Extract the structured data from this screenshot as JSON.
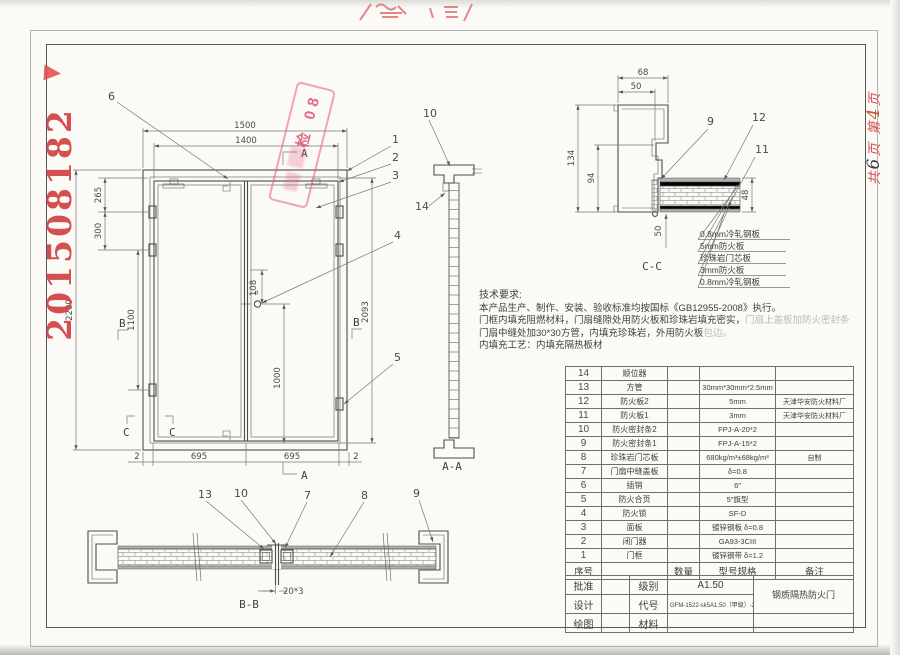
{
  "stamps": {
    "serial": "201508182",
    "inspection": "检 08",
    "page_note": {
      "p1": "共",
      "n1": "6",
      "p2": "页",
      "p3": "第",
      "n2": "4",
      "p4": "页"
    }
  },
  "elevation": {
    "dims": {
      "w_frame": "1500",
      "w_leaf": "1400",
      "h_frame": "2200",
      "h_leaf": "2093",
      "hinge1": "265",
      "hinge2": "300",
      "hinge3": "1100",
      "lock_off": "108",
      "lock_h": "1000",
      "gap_l": "2",
      "leaf_l": "695",
      "leaf_r": "695",
      "gap_r": "2"
    },
    "leaders": {
      "n1": "1",
      "n2": "2",
      "n3": "3",
      "n4": "4",
      "n5": "5",
      "n6": "6",
      "n10": "10",
      "n14": "14"
    },
    "marks": {
      "a": "A",
      "b": "B",
      "c": "C"
    }
  },
  "section_aa": {
    "label": "A-A"
  },
  "section_bb": {
    "label": "B-B",
    "dim": "20*3",
    "leaders": {
      "n13": "13",
      "n10": "10",
      "n7": "7",
      "n8": "8",
      "n9": "9"
    }
  },
  "detail_cc": {
    "label": "C-C",
    "dims": {
      "d68": "68",
      "d50": "50",
      "d134": "134",
      "d94": "94",
      "d48": "48",
      "d50b": "50"
    },
    "leaders": {
      "n9": "9",
      "n12": "12",
      "n11": "11"
    },
    "layers": [
      "0.8mm冷轧钢板",
      "5mm防火板",
      "珍珠岩门芯板",
      "3mm防火板",
      "0.8mm冷轧钢板"
    ]
  },
  "tech": {
    "title": "技术要求:",
    "line1": "本产品生产、制作、安装、验收标准均按国标《GB12955-2008》执行。",
    "line2": "门框内填充阻燃材料，门扇缝隙处用防火板和珍珠岩填充密实，",
    "line2_faded": "门扇上盖板加防火密封条",
    "line3": "门扇中缝处加30*30方管，内填充珍珠岩，外用防火板",
    "line3_faded": "包边。",
    "line4": "内填充工艺：内填充隔热板材"
  },
  "parts_table": {
    "header": {
      "no": "序号",
      "name": "",
      "qty": "数量",
      "spec": "型号规格",
      "note": "备注"
    },
    "rows": [
      {
        "no": "14",
        "name": "顺位器",
        "qty": "",
        "spec": "",
        "note": ""
      },
      {
        "no": "13",
        "name": "方管",
        "qty": "",
        "spec": "30mm*30mm*2.5mm",
        "note": ""
      },
      {
        "no": "12",
        "name": "防火板2",
        "qty": "",
        "spec": "5mm",
        "note": "天津华安防火材料厂"
      },
      {
        "no": "11",
        "name": "防火板1",
        "qty": "",
        "spec": "3mm",
        "note": "天津华安防火材料厂"
      },
      {
        "no": "10",
        "name": "防火密封条2",
        "qty": "",
        "spec": "FPJ-A-20*2",
        "note": ""
      },
      {
        "no": "9",
        "name": "防火密封条1",
        "qty": "",
        "spec": "FPJ-A-15*2",
        "note": ""
      },
      {
        "no": "8",
        "name": "珍珠岩门芯板",
        "qty": "",
        "spec": "680kg/m³±68kg/m³",
        "note": "自制"
      },
      {
        "no": "7",
        "name": "门扇中缝盖板",
        "qty": "",
        "spec": "δ=0.8",
        "note": ""
      },
      {
        "no": "6",
        "name": "插销",
        "qty": "",
        "spec": "6″",
        "note": ""
      },
      {
        "no": "5",
        "name": "防火合页",
        "qty": "",
        "spec": "5″旗型",
        "note": ""
      },
      {
        "no": "4",
        "name": "防火锁",
        "qty": "",
        "spec": "SF-D",
        "note": ""
      },
      {
        "no": "3",
        "name": "面板",
        "qty": "",
        "spec": "镀锌钢板 δ=0.8",
        "note": ""
      },
      {
        "no": "2",
        "name": "闭门器",
        "qty": "",
        "spec": "GA93-3CIII",
        "note": ""
      },
      {
        "no": "1",
        "name": "门框",
        "qty": "",
        "spec": "镀锌钢带 δ=1.2",
        "note": ""
      }
    ]
  },
  "title_block": {
    "r1l": "批准",
    "r1k": "级别",
    "r1v": "A1.50",
    "r2l": "设计",
    "r2k": "代号",
    "r2v": "GFM-1522-sk5A1.50（甲级）-2",
    "r3l": "绘图",
    "r3k": "材料",
    "r3v": "",
    "product": "钢质隔热防火门"
  }
}
